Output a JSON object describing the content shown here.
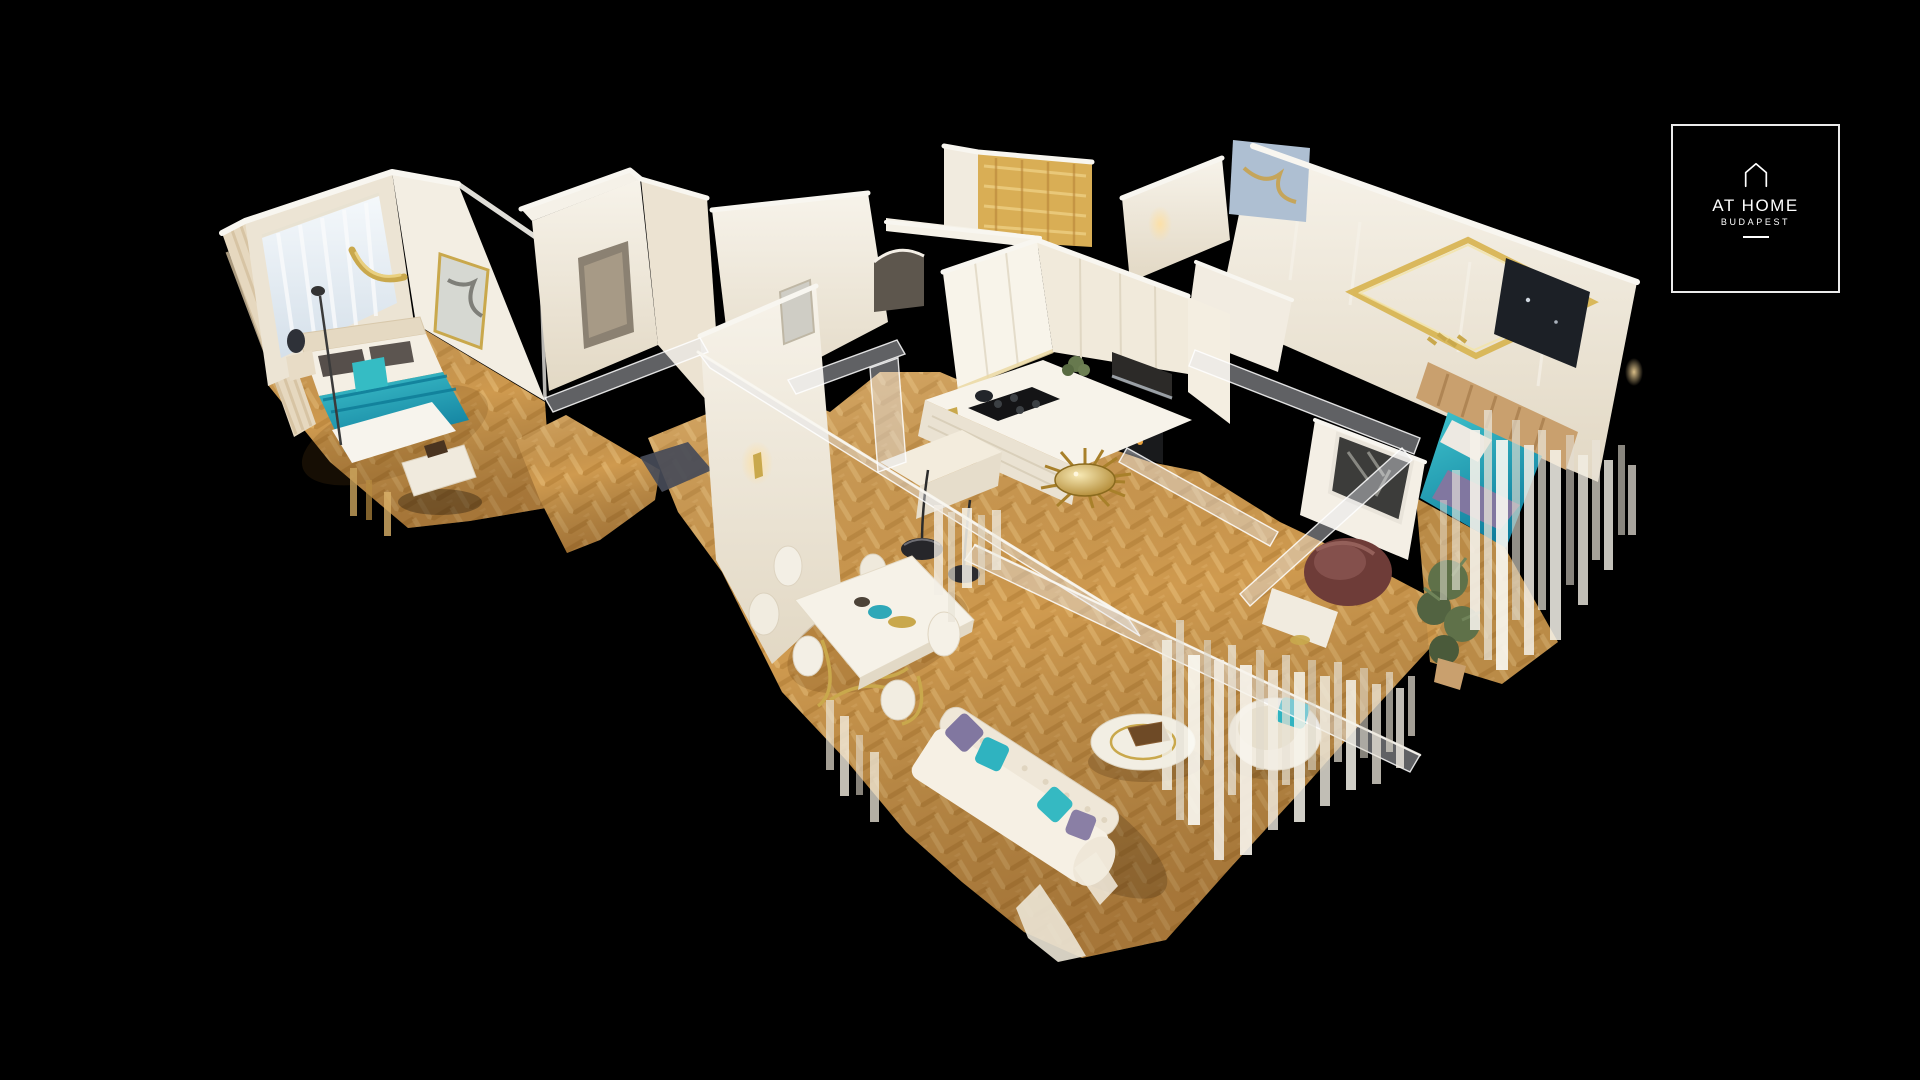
{
  "logo": {
    "title": "AT HOME",
    "subtitle": "BUDAPEST",
    "icon": "house-outline-icon"
  },
  "colors": {
    "bg": "#000000",
    "trim": "#f8f6f0",
    "wall": "#efe8da",
    "wall_dark": "#ddd1bb",
    "wood": "#cf9a4f",
    "wood_dark": "#b17c33",
    "wood_light": "#e6ba74",
    "teal": "#3fc3cc",
    "teal_deep": "#117f9e",
    "gold": "#c9a84c",
    "gold_deep": "#a87c22",
    "tan": "#c9a06e",
    "purple": "#8177a0",
    "dark": "#24262b",
    "marble_blue": "#aebfd2",
    "plant": "#5f7149",
    "burgundy": "#6e3c38"
  }
}
